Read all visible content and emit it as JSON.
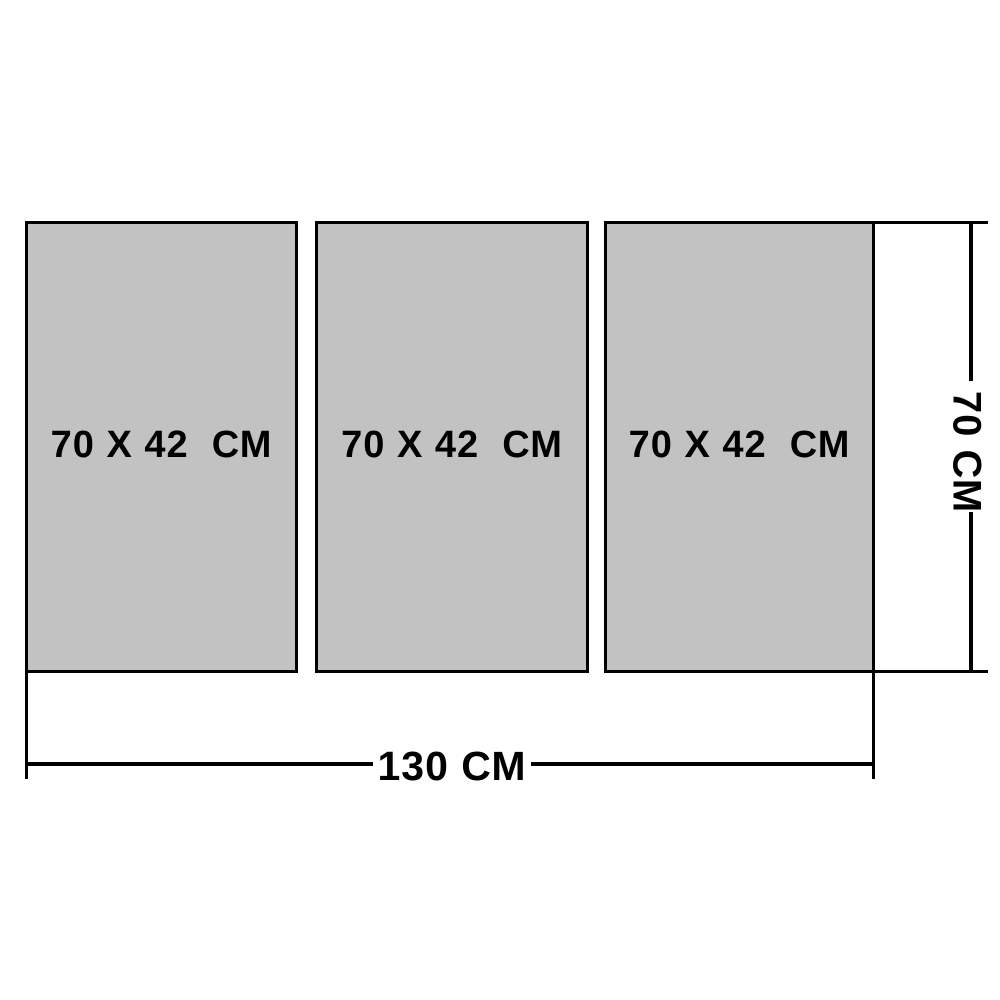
{
  "diagram": {
    "panels": [
      {
        "label": "70 X 42  СМ"
      },
      {
        "label": "70 X 42  СМ"
      },
      {
        "label": "70 X 42  СМ"
      }
    ],
    "dimensions": {
      "total_width_label": "130 СМ",
      "total_height_label": "70 СМ"
    },
    "colors": {
      "panel_fill": "#c2c2c2",
      "line": "#000000",
      "background": "#ffffff",
      "text": "#000000"
    }
  }
}
